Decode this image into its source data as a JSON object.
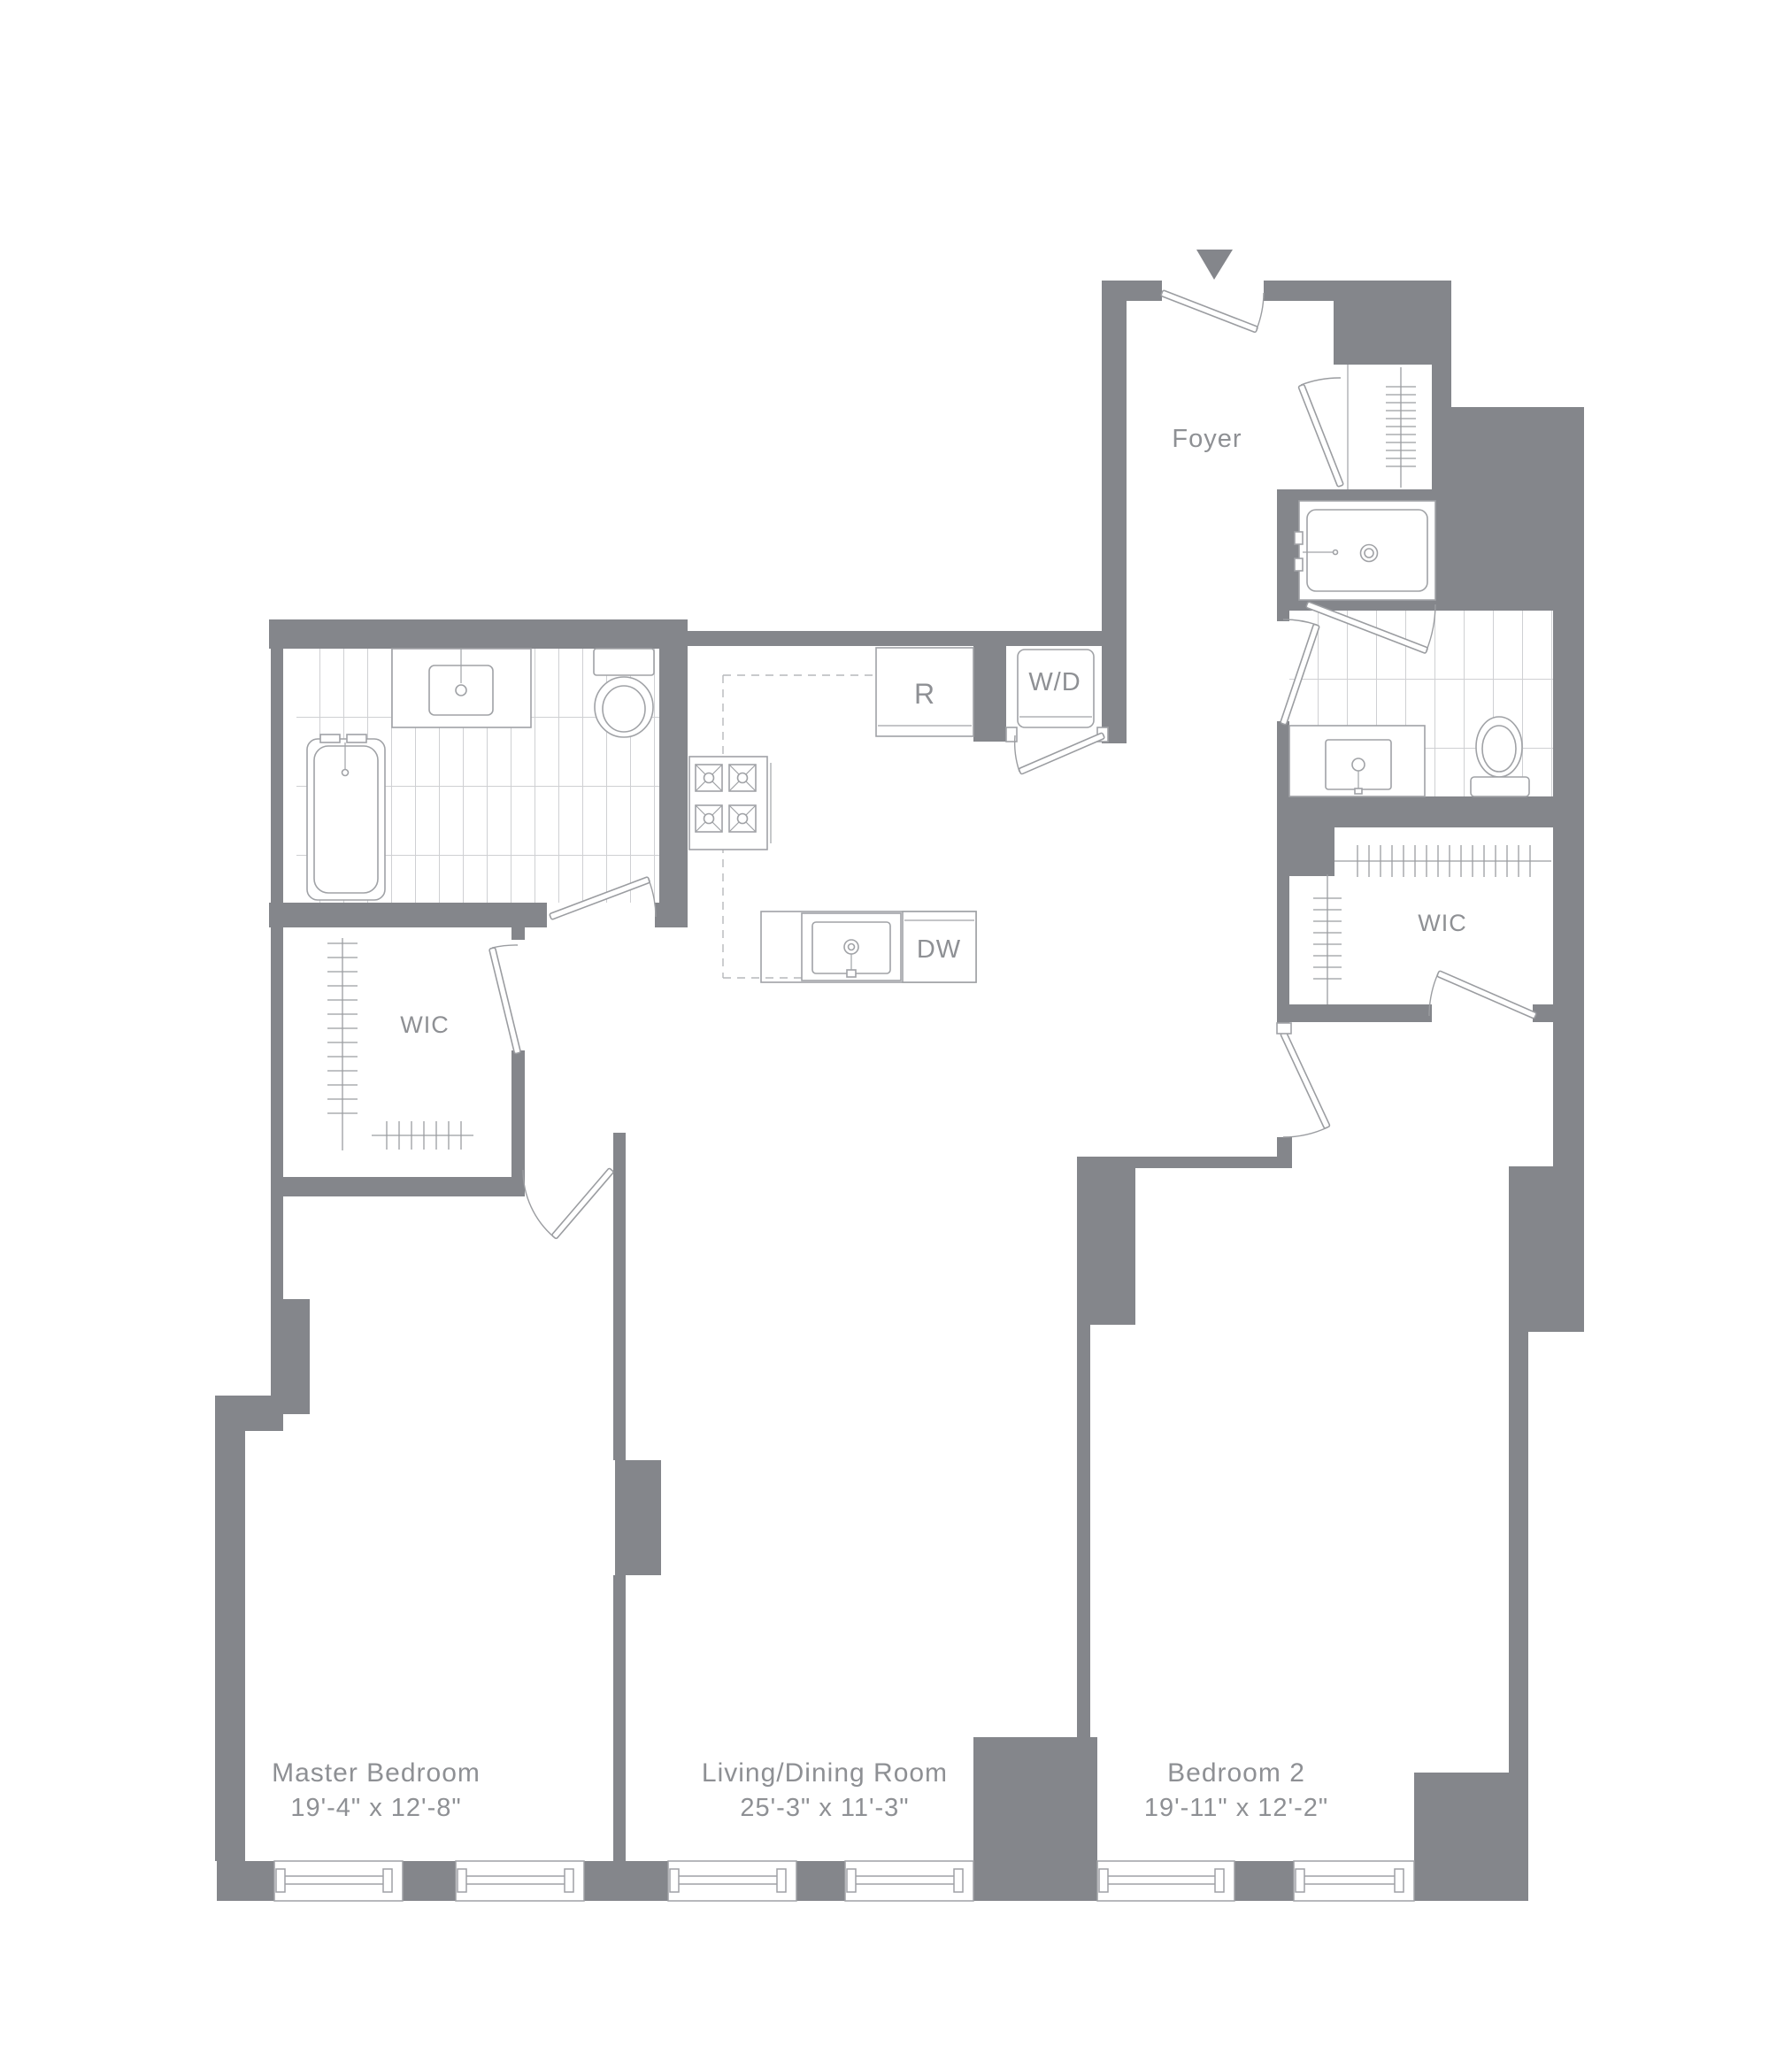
{
  "plan": {
    "type": "apartment-floor-plan",
    "colors": {
      "wall": "#84868b",
      "fixture_line": "#a0a2a6",
      "tile_line": "#cfd0d3",
      "text": "#8e9094",
      "background": "#ffffff"
    },
    "entry_marker": "entry-arrow"
  },
  "rooms": {
    "foyer": {
      "name": "Foyer"
    },
    "master": {
      "name": "Master Bedroom",
      "dims": "19'-4\" x 12'-8\""
    },
    "living": {
      "name": "Living/Dining Room",
      "dims": "25'-3\" x 11'-3\""
    },
    "bedroom2": {
      "name": "Bedroom 2",
      "dims": "19'-11\" x 12'-2\""
    },
    "wic_left": {
      "name": "WIC"
    },
    "wic_right": {
      "name": "WIC"
    }
  },
  "appliances": {
    "refrigerator": "R",
    "washer_dryer": "W/D",
    "dishwasher": "DW"
  }
}
